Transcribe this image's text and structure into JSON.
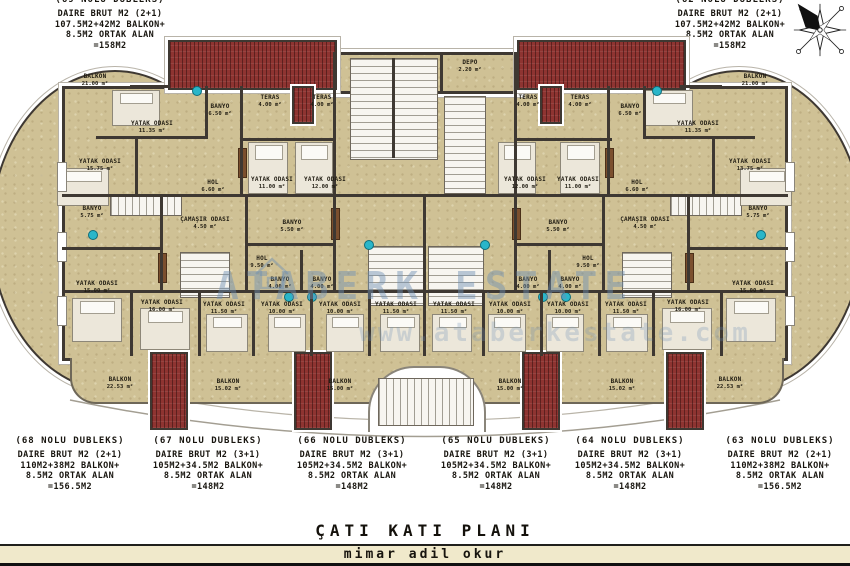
{
  "title": "ÇATI KATI PLANI",
  "architect": "mimar adil okur",
  "watermark": {
    "line1": "ATABERK ESTATE",
    "line2": "www.ataberkestate.com"
  },
  "colors": {
    "floor_beige": "#cfc195",
    "wall_dark": "#3e3832",
    "roof_red": "#8e3431",
    "fixture_teal": "#2ab6c9",
    "watermark_blue": "#6d8fb4",
    "footer_bar": "#f0e9cb"
  },
  "top_units": [
    {
      "name": "(69 NOLU DUBLEKS)",
      "x": 110,
      "lines": [
        "DAIRE BRUT M2 (2+1)",
        "107.5M2+42M2 BALKON+",
        "8.5M2 ORTAK ALAN",
        "=158M2"
      ]
    },
    {
      "name": "(62 NOLU DUBLEKS)",
      "x": 730,
      "lines": [
        "DAIRE BRUT M2 (2+1)",
        "107.5M2+42M2 BALKON+",
        "8.5M2 ORTAK ALAN",
        "=158M2"
      ]
    }
  ],
  "bottom_units": [
    {
      "name": "(68 NOLU DUBLEKS)",
      "x": 70,
      "lines": [
        "DAIRE BRUT M2 (2+1)",
        "110M2+38M2 BALKON+",
        "8.5M2 ORTAK ALAN",
        "=156.5M2"
      ]
    },
    {
      "name": "(67 NOLU DUBLEKS)",
      "x": 208,
      "lines": [
        "DAIRE BRUT M2 (3+1)",
        "105M2+34.5M2 BALKON+",
        "8.5M2 ORTAK ALAN",
        "=148M2"
      ]
    },
    {
      "name": "(66 NOLU DUBLEKS)",
      "x": 352,
      "lines": [
        "DAIRE BRUT M2 (3+1)",
        "105M2+34.5M2 BALKON+",
        "8.5M2 ORTAK ALAN",
        "=148M2"
      ]
    },
    {
      "name": "(65 NOLU DUBLEKS)",
      "x": 496,
      "lines": [
        "DAIRE BRUT M2 (3+1)",
        "105M2+34.5M2 BALKON+",
        "8.5M2 ORTAK ALAN",
        "=148M2"
      ]
    },
    {
      "name": "(64 NOLU DUBLEKS)",
      "x": 630,
      "lines": [
        "DAIRE BRUT M2 (3+1)",
        "105M2+34.5M2 BALKON+",
        "8.5M2 ORTAK ALAN",
        "=148M2"
      ]
    },
    {
      "name": "(63 NOLU DUBLEKS)",
      "x": 780,
      "lines": [
        "DAIRE BRUT M2 (2+1)",
        "110M2+38M2 BALKON+",
        "8.5M2 ORTAK ALAN",
        "=156.5M2"
      ]
    }
  ],
  "rooms": [
    {
      "name": "BALKON",
      "area": "21.00 m²",
      "x": 95,
      "y": 80
    },
    {
      "name": "BALKON",
      "area": "21.00 m²",
      "x": 755,
      "y": 80
    },
    {
      "name": "YATAK ODASI",
      "area": "11.35 m²",
      "x": 152,
      "y": 127
    },
    {
      "name": "YATAK ODASI",
      "area": "11.35 m²",
      "x": 698,
      "y": 127
    },
    {
      "name": "BANYO",
      "area": "6.50 m²",
      "x": 220,
      "y": 110
    },
    {
      "name": "BANYO",
      "area": "6.50 m²",
      "x": 630,
      "y": 110
    },
    {
      "name": "YATAK ODASI",
      "area": "15.75 m²",
      "x": 100,
      "y": 165
    },
    {
      "name": "YATAK ODASI",
      "area": "13.75 m²",
      "x": 750,
      "y": 165
    },
    {
      "name": "HOL",
      "area": "6.60 m²",
      "x": 213,
      "y": 186
    },
    {
      "name": "HOL",
      "area": "6.60 m²",
      "x": 637,
      "y": 186
    },
    {
      "name": "TERAS",
      "area": "4.00 m²",
      "x": 270,
      "y": 101
    },
    {
      "name": "TERAS",
      "area": "4.00 m²",
      "x": 322,
      "y": 101
    },
    {
      "name": "TERAS",
      "area": "4.00 m²",
      "x": 528,
      "y": 101
    },
    {
      "name": "TERAS",
      "area": "4.00 m²",
      "x": 580,
      "y": 101
    },
    {
      "name": "DEPO",
      "area": "2.20 m²",
      "x": 470,
      "y": 66
    },
    {
      "name": "YATAK ODASI",
      "area": "11.00 m²",
      "x": 272,
      "y": 183
    },
    {
      "name": "YATAK ODASI",
      "area": "12.00 m²",
      "x": 325,
      "y": 183
    },
    {
      "name": "YATAK ODASI",
      "area": "12.00 m²",
      "x": 525,
      "y": 183
    },
    {
      "name": "YATAK ODASI",
      "area": "11.00 m²",
      "x": 578,
      "y": 183
    },
    {
      "name": "BANYO",
      "area": "5.75 m²",
      "x": 92,
      "y": 212
    },
    {
      "name": "BANYO",
      "area": "5.75 m²",
      "x": 758,
      "y": 212
    },
    {
      "name": "ÇAMAŞIR ODASI",
      "area": "4.50 m²",
      "x": 205,
      "y": 223
    },
    {
      "name": "ÇAMAŞIR ODASI",
      "area": "4.50 m²",
      "x": 645,
      "y": 223
    },
    {
      "name": "BANYO",
      "area": "5.50 m²",
      "x": 292,
      "y": 226
    },
    {
      "name": "BANYO",
      "area": "5.50 m²",
      "x": 558,
      "y": 226
    },
    {
      "name": "HOL",
      "area": "9.50 m²",
      "x": 262,
      "y": 262
    },
    {
      "name": "HOL",
      "area": "9.50 m²",
      "x": 588,
      "y": 262
    },
    {
      "name": "BANYO",
      "area": "4.00 m²",
      "x": 280,
      "y": 283
    },
    {
      "name": "BANYO",
      "area": "4.00 m²",
      "x": 322,
      "y": 283
    },
    {
      "name": "BANYO",
      "area": "4.00 m²",
      "x": 528,
      "y": 283
    },
    {
      "name": "BANYO",
      "area": "4.00 m²",
      "x": 570,
      "y": 283
    },
    {
      "name": "YATAK ODASI",
      "area": "15.00 m²",
      "x": 97,
      "y": 287
    },
    {
      "name": "YATAK ODASI",
      "area": "15.00 m²",
      "x": 753,
      "y": 287
    },
    {
      "name": "YATAK ODASI",
      "area": "16.00 m²",
      "x": 162,
      "y": 306
    },
    {
      "name": "YATAK ODASI",
      "area": "16.00 m²",
      "x": 688,
      "y": 306
    },
    {
      "name": "YATAK ODASI",
      "area": "11.50 m²",
      "x": 224,
      "y": 308
    },
    {
      "name": "YATAK ODASI",
      "area": "11.50 m²",
      "x": 396,
      "y": 308
    },
    {
      "name": "YATAK ODASI",
      "area": "11.50 m²",
      "x": 454,
      "y": 308
    },
    {
      "name": "YATAK ODASI",
      "area": "11.50 m²",
      "x": 626,
      "y": 308
    },
    {
      "name": "YATAK ODASI",
      "area": "10.00 m²",
      "x": 282,
      "y": 308
    },
    {
      "name": "YATAK ODASI",
      "area": "10.00 m²",
      "x": 340,
      "y": 308
    },
    {
      "name": "YATAK ODASI",
      "area": "10.00 m²",
      "x": 510,
      "y": 308
    },
    {
      "name": "YATAK ODASI",
      "area": "10.00 m²",
      "x": 568,
      "y": 308
    },
    {
      "name": "BALKON",
      "area": "22.53 m²",
      "x": 120,
      "y": 383
    },
    {
      "name": "BALKON",
      "area": "15.02 m²",
      "x": 228,
      "y": 385
    },
    {
      "name": "BALKON",
      "area": "15.00 m²",
      "x": 340,
      "y": 385
    },
    {
      "name": "BALKON",
      "area": "15.00 m²",
      "x": 510,
      "y": 385
    },
    {
      "name": "BALKON",
      "area": "15.02 m²",
      "x": 622,
      "y": 385
    },
    {
      "name": "BALKON",
      "area": "22.53 m²",
      "x": 730,
      "y": 383
    }
  ]
}
